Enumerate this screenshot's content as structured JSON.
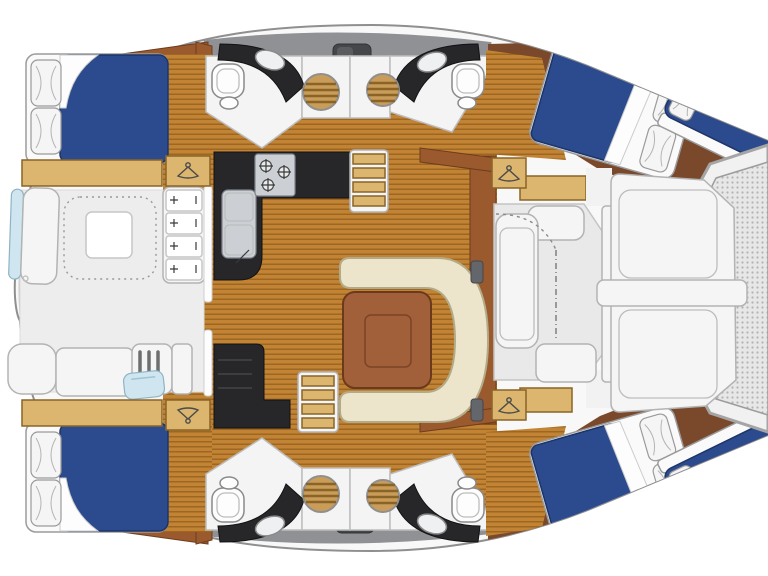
{
  "figure": {
    "type": "floor-plan",
    "subject": "Catamaran yacht accommodation deck plan, top-down view, bow to the right",
    "orientation": "bow-right"
  },
  "colors": {
    "hull_stroke": "#8f8f8f",
    "roof_gray": "#909195",
    "hatch_dark": "#45474b",
    "wood_floor": "#c28434",
    "wood_floor_stripe": "#9c6722",
    "shelf_tan": "#dcb56e",
    "shelf_border": "#8a6426",
    "trim_brown": "#9a5a2e",
    "dark_wood": "#7a482a",
    "table_wood": "#a2603a",
    "bed_blue": "#2c4b8e",
    "bed_blue_dark": "#1d3566",
    "mattress_white": "#fafafa",
    "outline_gray": "#9b9b9b",
    "cream": "#ece5cb",
    "cream_border": "#b3ab88",
    "counter_black": "#27272a",
    "steel": "#ccd0d4",
    "porthole_tan": "#c99c5a",
    "porthole_stripe": "#8a6426",
    "mesh_light": "#e7e7e7",
    "mesh_dot": "#b3b3b3",
    "accent_blue": "#cfe6f0"
  },
  "inventory": {
    "hulls": 2,
    "cabins": [
      {
        "id": "port-aft",
        "berth": "double",
        "pillows": 2
      },
      {
        "id": "starboard-aft",
        "berth": "double",
        "pillows": 2
      },
      {
        "id": "port-forward",
        "berth": "double",
        "pillows": 2
      },
      {
        "id": "starboard-forward",
        "berth": "double",
        "pillows": 2
      }
    ],
    "bow_single_berths": 2,
    "heads_with_toilet_and_sink": 4,
    "louvered_portholes": 4,
    "wardrobes_with_hanger": 4,
    "salon": [
      "galley-l-counter",
      "three-burner-stove",
      "double-sink",
      "u-shaped-dinette-sofa",
      "square-wood-table",
      "companionway-steps-port",
      "companionway-steps-starboard",
      "nav-steps-block"
    ],
    "aft_cockpit": [
      "curved-bench",
      "square-table",
      "dashed-rug",
      "drawer-unit-4-drawers",
      "bench-seats",
      "slatted-locker",
      "blue-sink-unit"
    ],
    "foredeck": [
      "forward-cockpit-seating",
      "sun-lounge-pad",
      "crossbeam-bar",
      "bow-trampoline"
    ],
    "deck_hatches": 2
  }
}
